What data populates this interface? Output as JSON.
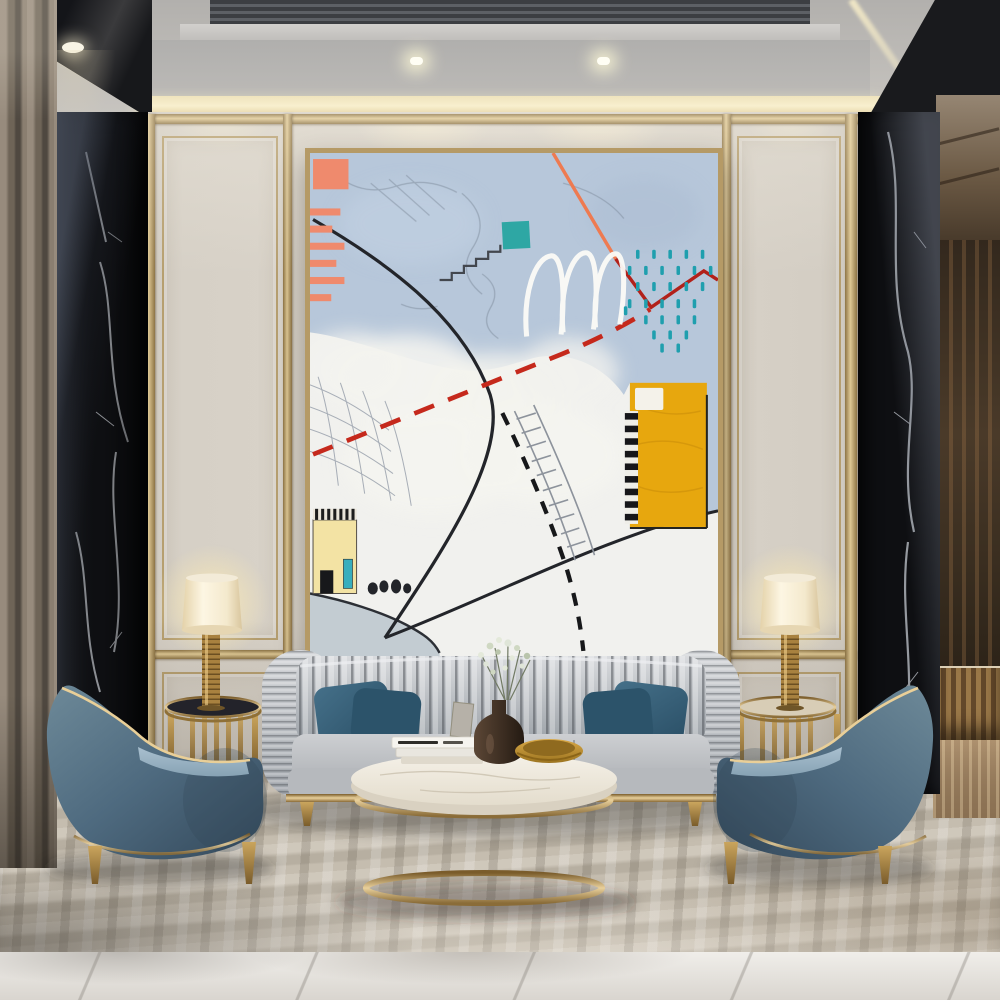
{
  "room": {
    "palette": {
      "wall_beige": "#d7d1c7",
      "gold_trim": "#b59a66",
      "gold_bright": "#e9d09b",
      "gold_dark": "#8a6c38",
      "ceiling_gray": "#b7b5b2",
      "cove_glow": "#f6ebc9",
      "marble_black": "#0e0f12",
      "marble_vein": "#d8dce2",
      "curtain_taupe": "#8a7e70",
      "carpet_base": "#c3bbad",
      "floor_marble": "#eceae6",
      "hallway_brown": "#4a3a29"
    },
    "counts": {
      "armchairs": 2,
      "sofa_pillows": 4,
      "lamps": 2,
      "side_tables": 2,
      "ceiling_spotlights": 2
    }
  },
  "painting": {
    "frame_gold": "#b59a66",
    "canvas_blue": "#b7c7da",
    "canvas_white": "#f1f1ee",
    "salmon": "#ef8a6d",
    "teal_square": "#2ea7a4",
    "teal_dash": "#1f9fae",
    "red_dash": "#c5291c",
    "dark_red": "#b2211a",
    "orange_line": "#ee7a50",
    "yellow_block": "#e7a70e",
    "pale_yellow_house": "#f3e3a4",
    "ink_black": "#23252a",
    "grid_gray": "#9aa2ad",
    "hill_gray": "#c3ccd2",
    "white_stroke": "#fbfbf7"
  },
  "furniture": {
    "sofa_silver_light": "#d9dbde",
    "sofa_silver_dark": "#9aa0a6",
    "seat_gray": "#cdcfd2",
    "pillow_teal_light": "#457089",
    "pillow_teal_dark": "#2a4f66",
    "chair_blue_light": "#6d8998",
    "chair_blue_mid": "#4e6a7f",
    "chair_blue_dark": "#33485a",
    "chair_cushion": "#a9c0cf",
    "gold_leg_light": "#caa55d",
    "gold_leg_dark": "#7a5c2b",
    "table_top_marble": "#f5f1e8",
    "table_side": "#e4ddcd",
    "lamp_shade": "#fdf6e3",
    "lamp_shade_edge": "#d9c69e",
    "vase_brown": "#5c4736",
    "bowl_gold": "#d8a847",
    "book_white": "#f6f4ef"
  }
}
